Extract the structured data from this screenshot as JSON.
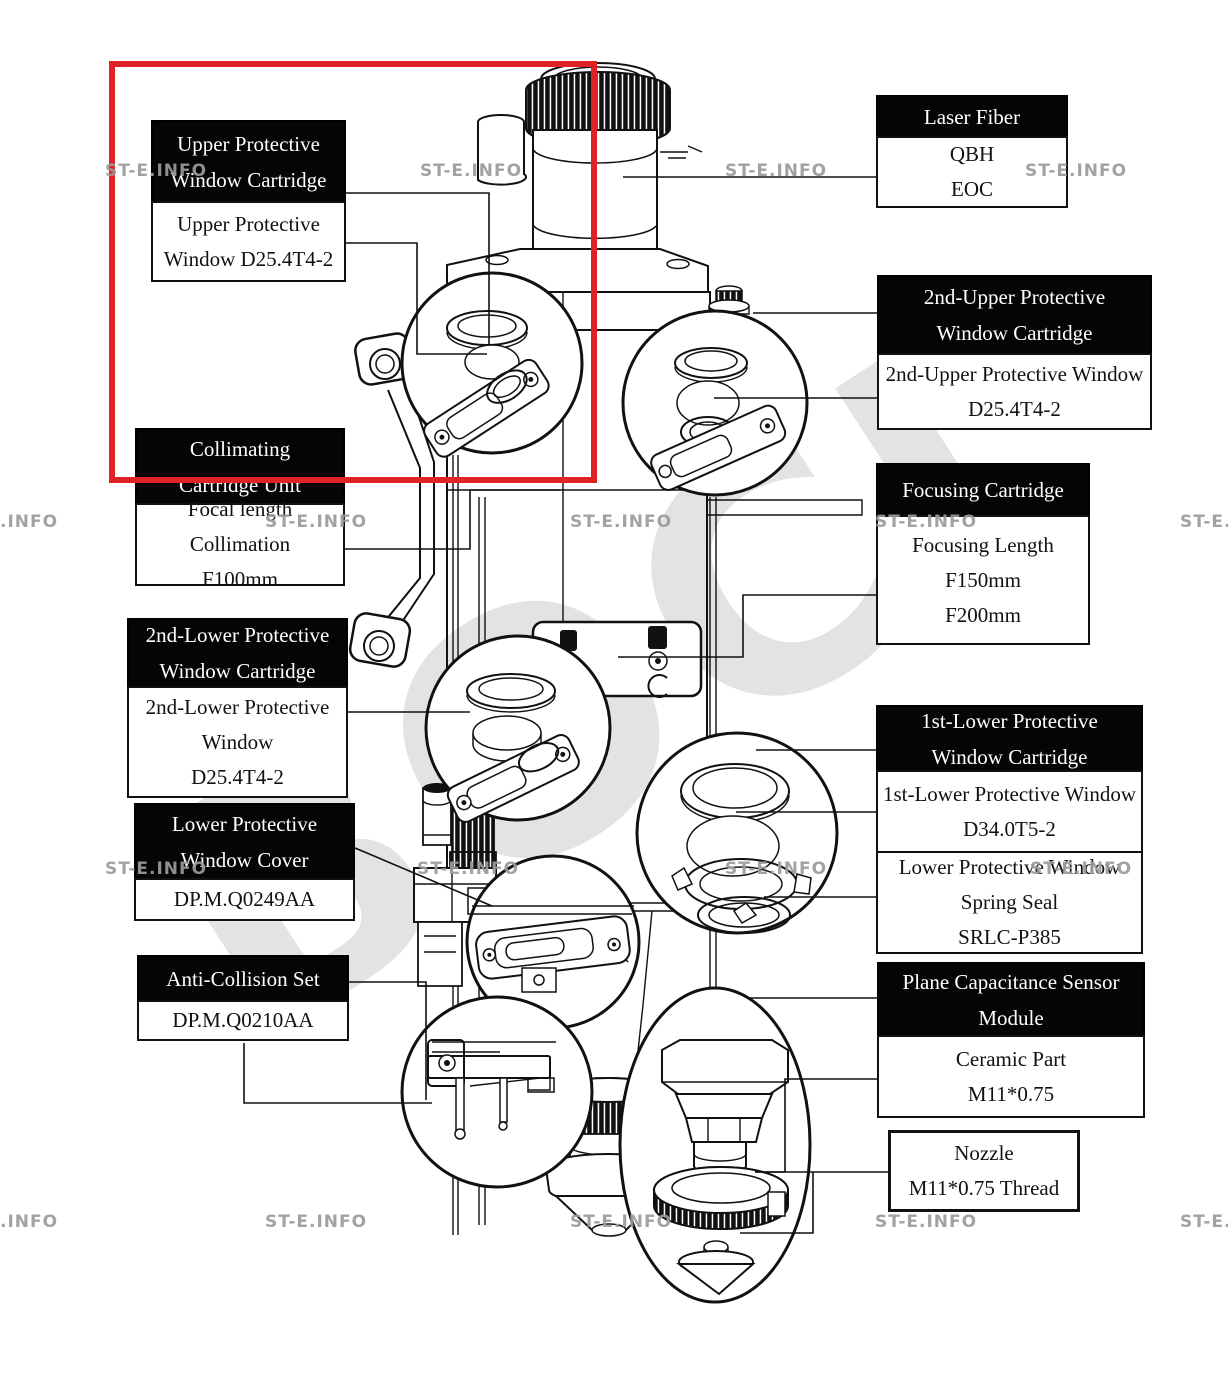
{
  "diagram_title": "Laser cutting head parts diagram",
  "colors": {
    "highlight_red": "#e02126",
    "line_black": "#111111",
    "watermark_gray": "#9b9b9b",
    "brand_gray": "#c9c9c9"
  },
  "watermark": {
    "tile": "ST-E.INFO",
    "tile_left_clip": ".INFO",
    "tile_right_clip": "ST-E.",
    "brand": "BOCI"
  },
  "callouts": [
    {
      "id": "upper-protective-window-cartridge",
      "header": [
        "Upper Protective",
        "Window Cartridge"
      ],
      "body": [
        "Upper Protective",
        "Window D25.4T4-2"
      ]
    },
    {
      "id": "laser-fiber",
      "header": [
        "Laser Fiber"
      ],
      "body": [
        "QBH",
        "EOC"
      ]
    },
    {
      "id": "2nd-upper-protective-window-cartridge",
      "header": [
        "2nd-Upper Protective",
        "Window Cartridge"
      ],
      "body": [
        "2nd-Upper Protective Window",
        "D25.4T4-2"
      ]
    },
    {
      "id": "collimating-cartridge-unit",
      "header": [
        "Collimating",
        "Cartridge Unit"
      ],
      "body": [
        "Focal length Collimation",
        "F100mm"
      ]
    },
    {
      "id": "focusing-cartridge",
      "header": [
        "Focusing Cartridge"
      ],
      "body": [
        "Focusing Length",
        "F150mm",
        "F200mm"
      ]
    },
    {
      "id": "2nd-lower-protective-window-cartridge",
      "header": [
        "2nd-Lower Protective",
        "Window Cartridge"
      ],
      "body": [
        "2nd-Lower Protective",
        "Window",
        "D25.4T4-2"
      ]
    },
    {
      "id": "lower-protective-window-cover",
      "header": [
        "Lower Protective",
        "Window Cover"
      ],
      "body": [
        "DP.M.Q0249AA"
      ]
    },
    {
      "id": "anti-collision-set",
      "header": [
        "Anti-Collision Set"
      ],
      "body": [
        "DP.M.Q0210AA"
      ]
    },
    {
      "id": "1st-lower-protective-window-cartridge",
      "header": [
        "1st-Lower Protective",
        "Window Cartridge"
      ],
      "body": [
        "1st-Lower Protective Window",
        "D34.0T5-2"
      ],
      "extra": [
        "Lower Protective Window",
        "Spring Seal",
        "SRLC-P385"
      ]
    },
    {
      "id": "plane-capacitance-sensor-module",
      "header": [
        "Plane Capacitance Sensor",
        "Module"
      ],
      "body": [
        "Ceramic Part",
        "M11*0.75"
      ]
    },
    {
      "id": "nozzle",
      "body": [
        "Nozzle",
        "M11*0.75 Thread"
      ]
    }
  ]
}
